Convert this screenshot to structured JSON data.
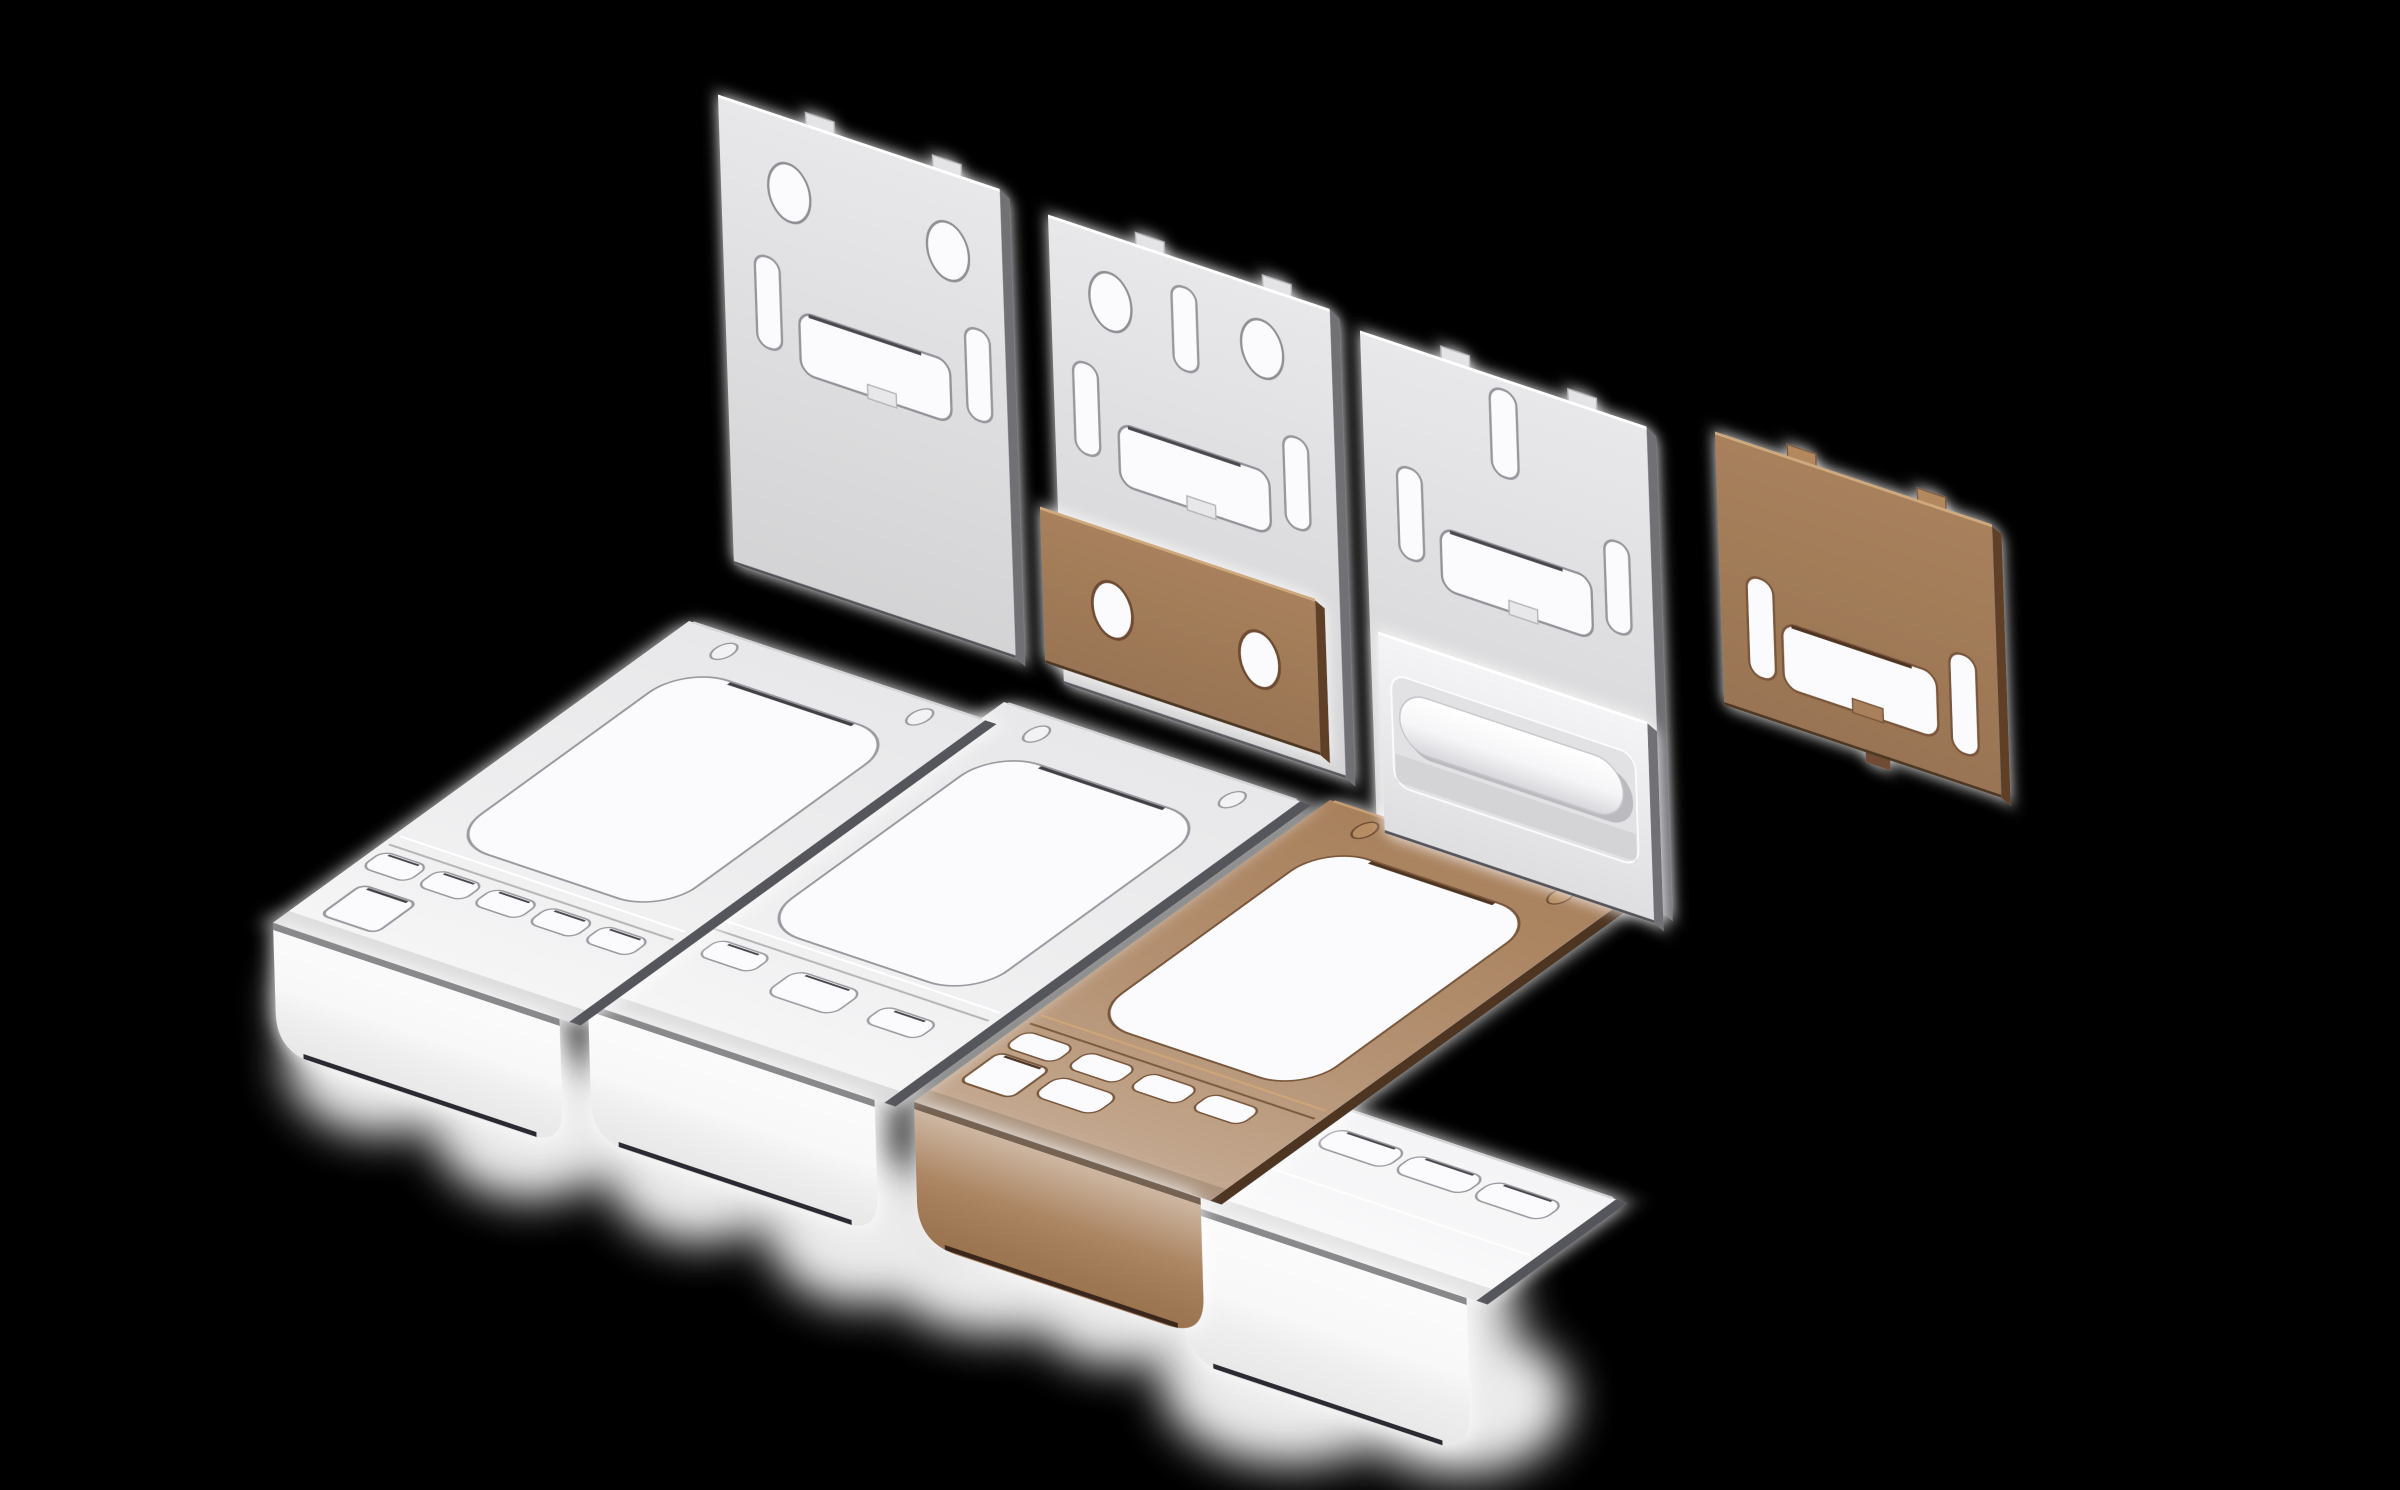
{
  "scene": {
    "description": "Isometric 3D render of nine stamped sheet-metal bracket parts floating over a black background, with soft white ground-shadow glows",
    "background": "#000000",
    "part_count": 9
  },
  "palette": {
    "background": "#000000",
    "white_face": "#e8e8ea",
    "white_face_bright": "#f4f4f6",
    "white_flange": "#f7f7f8",
    "white_edge": "#6f6f75",
    "white_rim": "#97979d",
    "dark_crevice": "#3f3f45",
    "hole": "#fbfbfd",
    "brown_face": "#a8805c",
    "brown_face_light": "#b68c63",
    "brown_flange": "#a47a54",
    "brown_edge": "#5f4026",
    "brown_rim": "#7a573a",
    "shadow_glow": "#ffffff"
  },
  "parts": [
    {
      "id": "plate-a",
      "label": "white wall plate with two oval holes",
      "color": "white",
      "oval_holes": 2,
      "side_slots": 2,
      "wide_cutouts": 1,
      "top_tabs": 2
    },
    {
      "id": "plate-b",
      "label": "white wall plate with two oval holes and top slot",
      "color": "white",
      "oval_holes": 2,
      "side_slots": 2,
      "top_slots": 1,
      "wide_cutouts": 1,
      "top_tabs": 2
    },
    {
      "id": "plate-c",
      "label": "white wall plate with top slot",
      "color": "white",
      "oval_holes": 0,
      "side_slots": 2,
      "top_slots": 1,
      "wide_cutouts": 1,
      "top_tabs": 2
    },
    {
      "id": "plate-brown-small",
      "label": "small brown plate with two round holes",
      "color": "brown",
      "round_holes": 2
    },
    {
      "id": "plate-handle-emboss",
      "label": "white plate with embossed handle rail",
      "color": "white",
      "emboss_rails": 1
    },
    {
      "id": "plate-brown-right",
      "label": "brown wall plate",
      "color": "brown",
      "side_slots": 2,
      "wide_cutouts": 1,
      "top_tabs": 2
    },
    {
      "id": "bracket-white-left",
      "label": "long white folded bracket",
      "color": "white",
      "big_cutouts": 1,
      "vent_slots": 5,
      "square_holes": 1,
      "rivet_dimples": 2
    },
    {
      "id": "bracket-white-middle",
      "label": "long white folded bracket",
      "color": "white",
      "big_cutouts": 1,
      "vent_slots": 3,
      "rivet_dimples": 2
    },
    {
      "id": "bracket-brown",
      "label": "long brown folded bracket",
      "color": "brown",
      "big_cutouts": 1,
      "vent_slots": 5,
      "square_holes": 1,
      "rivet_dimples": 2
    },
    {
      "id": "bracket-white-small",
      "label": "small white folded bracket",
      "color": "white",
      "vent_slots": 3
    }
  ]
}
